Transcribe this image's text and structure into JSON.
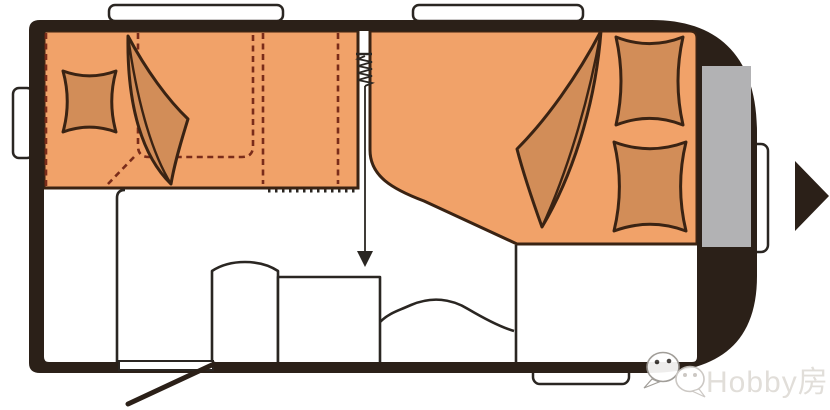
{
  "image": {
    "kind": "caravan-floor-plan",
    "watermark": {
      "label": "Hobby房车",
      "icon": "wechat-icon"
    },
    "front_direction_icon": "arrow-right-icon"
  },
  "colors": {
    "bed": "#F1A269",
    "bedding": "#D28D58",
    "outline": "#3A2313",
    "dash": "#7A2C1A",
    "body": "#2B2018",
    "glass": "#B2B2B4",
    "line": "#2A2622",
    "watermark": "#DCD8D3"
  }
}
